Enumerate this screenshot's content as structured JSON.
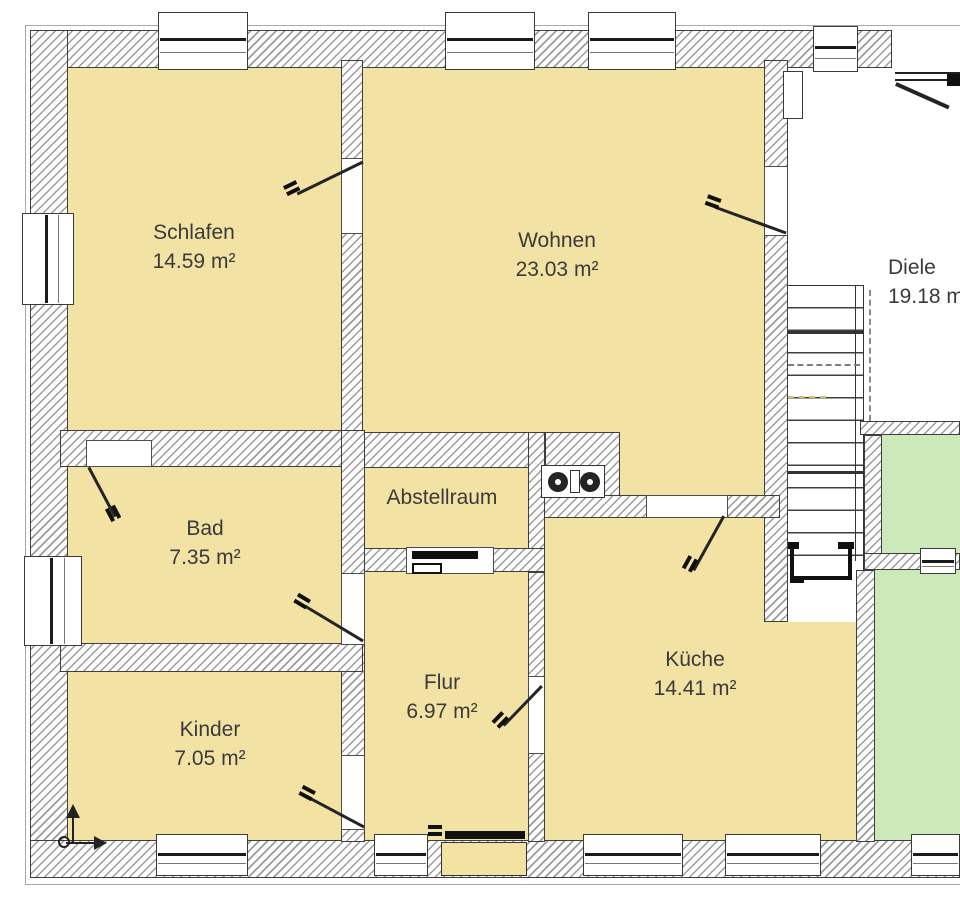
{
  "plan": {
    "rooms": [
      {
        "name": "Schlafen",
        "area": "14.59 m²"
      },
      {
        "name": "Wohnen",
        "area": "23.03 m²"
      },
      {
        "name": "Diele",
        "area": "19.18 m²"
      },
      {
        "name": "Bad",
        "area": "7.35 m²"
      },
      {
        "name": "Abstellraum",
        "area": ""
      },
      {
        "name": "Flur",
        "area": "6.97 m²"
      },
      {
        "name": "Kinder",
        "area": "7.05 m²"
      },
      {
        "name": "Küche",
        "area": "14.41 m²"
      }
    ],
    "colors": {
      "room_fill": "#f2e3a5",
      "outdoor_fill": "#cbe9b9",
      "floor_white": "#ffffff",
      "wall_line": "#3e3e3e",
      "hatch_line": "#9c9c9c",
      "label_text": "#3a3a3a"
    },
    "icons": {
      "stove": "stove-icon",
      "north_arrow": "north-arrow-icon",
      "stairs": "staircase-icon"
    }
  }
}
